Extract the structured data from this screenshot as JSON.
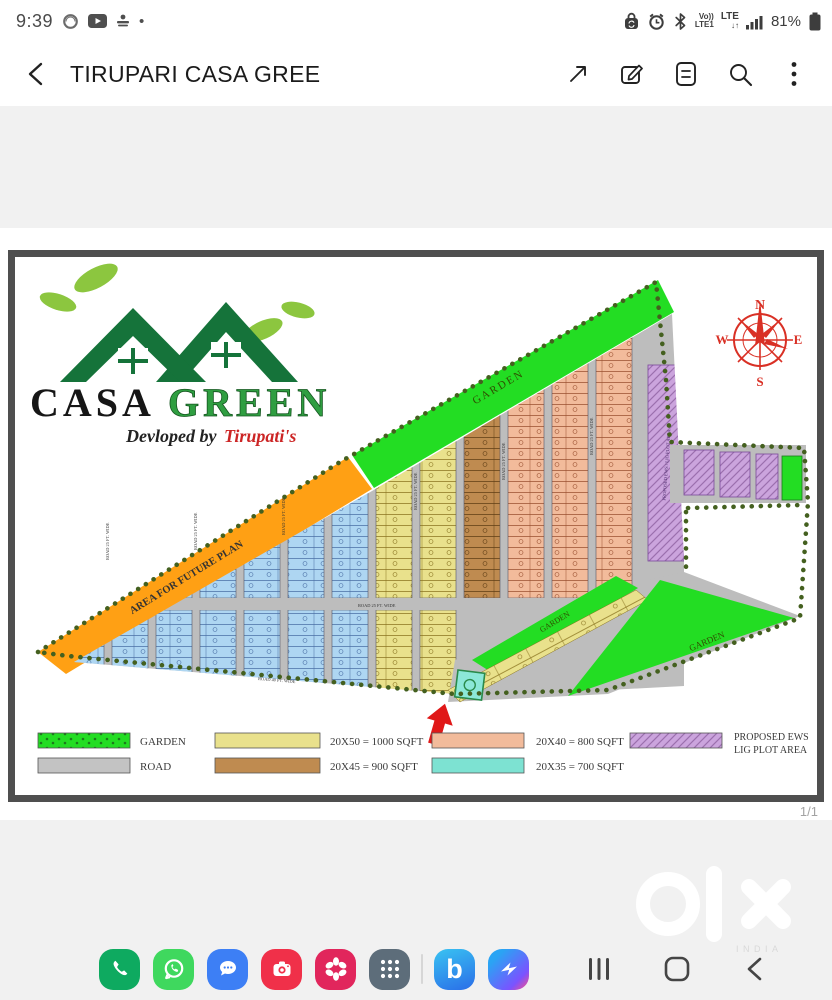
{
  "status_bar": {
    "time": "9:39",
    "notification_dot": "•",
    "volte_top": "Vo))",
    "volte_bottom": "LTE1",
    "network": "LTE",
    "network_arrows": "↓↑",
    "battery": "81%",
    "icons": [
      "badge-icon",
      "youtube-icon",
      "notification-icon",
      "lock-sync-icon",
      "alarm-icon",
      "bluetooth-icon",
      "signal-icon",
      "battery-icon"
    ]
  },
  "header": {
    "title": "TIRUPARI CASA GREE",
    "icons": [
      "back",
      "expand",
      "edit",
      "document",
      "search",
      "more"
    ]
  },
  "viewer": {
    "page_indicator": "1/1"
  },
  "map": {
    "logo": {
      "brand_black": "CASA",
      "brand_green": "GREEN",
      "tagline": "Devloped by",
      "tagline_name": "Tirupati's"
    },
    "compass": {
      "north": "N",
      "east": "E",
      "south": "S",
      "west": "W"
    },
    "labels": {
      "future_area": "AREA FOR FUTURE PLAN",
      "garden_top": "GARDEN",
      "garden_mid": "GARDEN",
      "garden_bottom": "GARDEN",
      "ews_strip": "PROPOSED EWS / LIG PLOT AREA",
      "road_main": "ROAD 25 FT. WIDE",
      "road_bottom": "ROAD 40 FT. WIDE"
    },
    "legend": {
      "garden": "GARDEN",
      "road": "ROAD",
      "sqft_1000": "20X50 = 1000 SQFT",
      "sqft_900": "20X45 = 900 SQFT",
      "sqft_800": "20X40 = 800 SQFT",
      "sqft_700": "20X35 = 700 SQFT",
      "ews_line1": "PROPOSED EWS",
      "ews_line2": "LIG  PLOT AREA"
    },
    "colors": {
      "garden": "#23dd23",
      "road": "#c3c3c3",
      "road_map": "#bdbdbd",
      "plot_1000": "#e9e18c",
      "plot_900": "#bf8b50",
      "plot_800": "#f2bb9b",
      "plot_700_legend": "#7de2d2",
      "plot_700_map": "#aed6f2",
      "ews": "#cba4dd",
      "future_plan": "#ffa014",
      "boundary_dots": "#44601f",
      "compass": "#d93025",
      "arrow": "#e01818"
    }
  },
  "watermark": {
    "brand": "olx",
    "country": "INDIA"
  },
  "taskbar": {
    "apps": [
      "phone",
      "whatsapp",
      "messages",
      "camera",
      "gallery",
      "apps-grid",
      "bixby",
      "messenger"
    ],
    "bixby_letter": "b",
    "nav": [
      "recents",
      "home",
      "back"
    ]
  }
}
